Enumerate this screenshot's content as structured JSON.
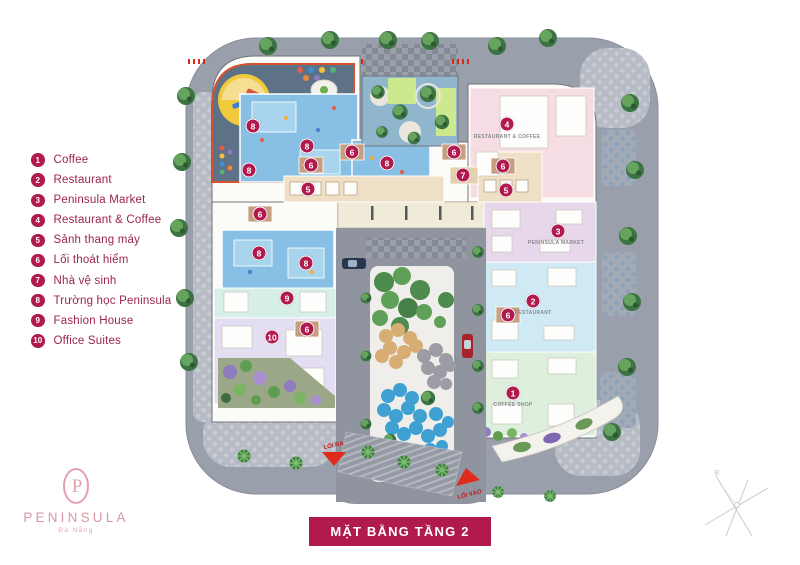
{
  "legend": {
    "items": [
      {
        "num": "1",
        "label": "Coffee"
      },
      {
        "num": "2",
        "label": "Restaurant"
      },
      {
        "num": "3",
        "label": "Peninsula Market"
      },
      {
        "num": "4",
        "label": "Restaurant & Coffee"
      },
      {
        "num": "5",
        "label": "Sảnh thang máy"
      },
      {
        "num": "6",
        "label": "Lối thoát hiểm"
      },
      {
        "num": "7",
        "label": "Nhà vệ sinh"
      },
      {
        "num": "8",
        "label": "Trường học Peninsula"
      },
      {
        "num": "9",
        "label": "Fashion House"
      },
      {
        "num": "10",
        "label": "Office Suites"
      }
    ]
  },
  "plan": {
    "markers": [
      {
        "num": "8",
        "x": 253,
        "y": 126
      },
      {
        "num": "8",
        "x": 307,
        "y": 146
      },
      {
        "num": "6",
        "x": 311,
        "y": 165
      },
      {
        "num": "8",
        "x": 249,
        "y": 170
      },
      {
        "num": "5",
        "x": 308,
        "y": 189
      },
      {
        "num": "6",
        "x": 352,
        "y": 152
      },
      {
        "num": "8",
        "x": 387,
        "y": 163
      },
      {
        "num": "6",
        "x": 454,
        "y": 152
      },
      {
        "num": "7",
        "x": 463,
        "y": 175
      },
      {
        "num": "4",
        "x": 507,
        "y": 124
      },
      {
        "num": "6",
        "x": 503,
        "y": 166
      },
      {
        "num": "5",
        "x": 506,
        "y": 190
      },
      {
        "num": "6",
        "x": 260,
        "y": 214
      },
      {
        "num": "3",
        "x": 558,
        "y": 231
      },
      {
        "num": "2",
        "x": 533,
        "y": 301
      },
      {
        "num": "6",
        "x": 508,
        "y": 315
      },
      {
        "num": "1",
        "x": 513,
        "y": 393
      },
      {
        "num": "8",
        "x": 259,
        "y": 253
      },
      {
        "num": "8",
        "x": 306,
        "y": 263
      },
      {
        "num": "9",
        "x": 287,
        "y": 298
      },
      {
        "num": "6",
        "x": 307,
        "y": 329
      },
      {
        "num": "10",
        "x": 272,
        "y": 337
      }
    ],
    "room_labels": [
      {
        "text": "RESTAURANT & COFFEE",
        "x": 507,
        "y": 137
      },
      {
        "text": "PENINSULA MARKET",
        "x": 556,
        "y": 243
      },
      {
        "text": "RESTAURANT",
        "x": 533,
        "y": 313
      },
      {
        "text": "COFFEE SHOP",
        "x": 513,
        "y": 405
      }
    ],
    "exit_label": "LỐI RA",
    "entrance_label": "LỐI VÀO",
    "compass_label": "B"
  },
  "banner": {
    "title": "MẶT BẰNG TẦNG 2"
  },
  "brand": {
    "monogram": "P",
    "name": "PENINSULA",
    "subtitle": "Đà Nẵng"
  },
  "colors": {
    "accent": "#b11a4e",
    "legend_text": "#9c2352",
    "logo_pink": "#e3a0ae",
    "road": "#9aa0ab"
  }
}
